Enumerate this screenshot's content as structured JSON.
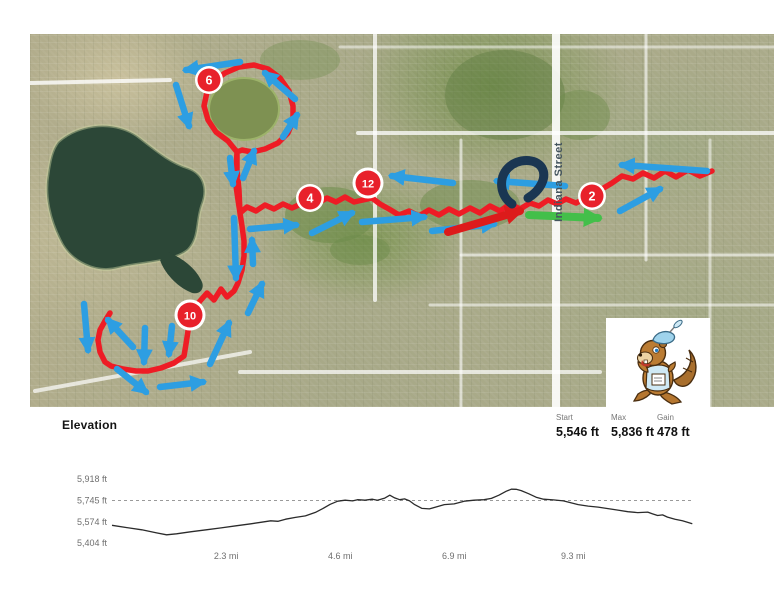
{
  "map": {
    "street_label": "Indiana Street",
    "route_color": "#ee1c25",
    "arrow_color": "#2d9ee2",
    "red_arrow_color": "#dd1b1b",
    "green_arrow_color": "#43bf4a",
    "logo_color": "#1a3652",
    "marker_fill": "#e8212b",
    "mile_markers": [
      {
        "label": "2",
        "x": 592,
        "y": 196
      },
      {
        "label": "4",
        "x": 310,
        "y": 198
      },
      {
        "label": "6",
        "x": 209,
        "y": 80
      },
      {
        "label": "10",
        "x": 190,
        "y": 315
      },
      {
        "label": "12",
        "x": 368,
        "y": 183
      }
    ],
    "route_points": [
      [
        712,
        171
      ],
      [
        700,
        176
      ],
      [
        688,
        170
      ],
      [
        676,
        177
      ],
      [
        665,
        171
      ],
      [
        654,
        178
      ],
      [
        643,
        173
      ],
      [
        633,
        179
      ],
      [
        622,
        176
      ],
      [
        612,
        183
      ],
      [
        602,
        189
      ],
      [
        594,
        194
      ],
      [
        586,
        198
      ],
      [
        576,
        203
      ],
      [
        566,
        199
      ],
      [
        557,
        204
      ],
      [
        548,
        200
      ],
      [
        539,
        206
      ],
      [
        530,
        203
      ],
      [
        520,
        209
      ],
      [
        510,
        204
      ],
      [
        500,
        211
      ],
      [
        490,
        206
      ],
      [
        480,
        213
      ],
      [
        470,
        208
      ],
      [
        459,
        214
      ],
      [
        449,
        209
      ],
      [
        439,
        215
      ],
      [
        429,
        210
      ],
      [
        419,
        216
      ],
      [
        409,
        211
      ],
      [
        399,
        215
      ],
      [
        389,
        209
      ],
      [
        380,
        204
      ],
      [
        372,
        198
      ],
      [
        363,
        200
      ],
      [
        354,
        202
      ],
      [
        345,
        197
      ],
      [
        336,
        202
      ],
      [
        327,
        198
      ],
      [
        318,
        203
      ],
      [
        310,
        199
      ],
      [
        301,
        204
      ],
      [
        292,
        208
      ],
      [
        283,
        204
      ],
      [
        274,
        209
      ],
      [
        265,
        205
      ],
      [
        256,
        211
      ],
      [
        247,
        207
      ],
      [
        240,
        213
      ],
      [
        238,
        200
      ],
      [
        236,
        186
      ],
      [
        236,
        170
      ],
      [
        237,
        152
      ],
      [
        228,
        141
      ],
      [
        216,
        132
      ],
      [
        208,
        120
      ],
      [
        204,
        106
      ],
      [
        207,
        92
      ],
      [
        214,
        81
      ],
      [
        225,
        73
      ],
      [
        239,
        67
      ],
      [
        254,
        65
      ],
      [
        268,
        69
      ],
      [
        280,
        78
      ],
      [
        289,
        91
      ],
      [
        293,
        106
      ],
      [
        293,
        121
      ],
      [
        288,
        133
      ],
      [
        278,
        143
      ],
      [
        265,
        149
      ],
      [
        252,
        152
      ],
      [
        242,
        150
      ],
      [
        237,
        152
      ],
      [
        237,
        170
      ],
      [
        239,
        190
      ],
      [
        240,
        213
      ],
      [
        242,
        226
      ],
      [
        244,
        241
      ],
      [
        244,
        256
      ],
      [
        242,
        270
      ],
      [
        238,
        283
      ],
      [
        234,
        291
      ],
      [
        227,
        297
      ],
      [
        221,
        289
      ],
      [
        214,
        300
      ],
      [
        207,
        293
      ],
      [
        200,
        301
      ],
      [
        194,
        309
      ],
      [
        190,
        318
      ],
      [
        188,
        331
      ],
      [
        186,
        344
      ],
      [
        184,
        356
      ],
      [
        174,
        363
      ],
      [
        161,
        368
      ],
      [
        148,
        371
      ],
      [
        136,
        371
      ],
      [
        123,
        369
      ],
      [
        111,
        366
      ],
      [
        105,
        362
      ],
      [
        100,
        352
      ],
      [
        98,
        340
      ],
      [
        100,
        330
      ],
      [
        105,
        321
      ],
      [
        110,
        313
      ]
    ],
    "direction_arrows": [
      [
        240,
        62,
        186,
        70
      ],
      [
        176,
        85,
        189,
        126
      ],
      [
        295,
        99,
        265,
        73
      ],
      [
        283,
        137,
        297,
        115
      ],
      [
        243,
        178,
        254,
        151
      ],
      [
        230,
        158,
        233,
        184
      ],
      [
        453,
        183,
        392,
        176
      ],
      [
        565,
        186,
        497,
        181
      ],
      [
        250,
        229,
        296,
        225
      ],
      [
        312,
        233,
        352,
        213
      ],
      [
        362,
        222,
        424,
        217
      ],
      [
        432,
        231,
        494,
        224
      ],
      [
        620,
        211,
        660,
        189
      ],
      [
        707,
        171,
        622,
        165
      ],
      [
        84,
        304,
        88,
        350
      ],
      [
        133,
        347,
        108,
        320
      ],
      [
        145,
        328,
        144,
        362
      ],
      [
        172,
        326,
        169,
        354
      ],
      [
        117,
        369,
        146,
        392
      ],
      [
        160,
        387,
        203,
        382
      ],
      [
        210,
        364,
        229,
        323
      ],
      [
        248,
        313,
        262,
        284
      ],
      [
        234,
        218,
        236,
        278
      ],
      [
        253,
        264,
        252,
        240
      ]
    ],
    "red_arrow": [
      448,
      232,
      520,
      211
    ],
    "green_arrow": [
      529,
      215,
      598,
      218
    ]
  },
  "elevation": {
    "section_label": "Elevation",
    "stats": [
      {
        "label": "Start",
        "value": "5,546 ft"
      },
      {
        "label": "Max",
        "value": "5,836 ft"
      },
      {
        "label": "Gain",
        "value": "478 ft"
      }
    ]
  },
  "chart_data": {
    "type": "line",
    "title": "Elevation",
    "x_units": "mi",
    "y_units": "ft",
    "x": [
      0,
      0.3,
      0.6,
      0.9,
      1.1,
      1.3,
      1.6,
      1.9,
      2.2,
      2.5,
      2.8,
      3.0,
      3.2,
      3.35,
      3.5,
      3.7,
      3.9,
      4.1,
      4.25,
      4.4,
      4.55,
      4.7,
      4.85,
      4.95,
      5.1,
      5.25,
      5.35,
      5.5,
      5.6,
      5.7,
      5.8,
      5.9,
      6.0,
      6.1,
      6.25,
      6.4,
      6.55,
      6.7,
      6.9,
      7.1,
      7.3,
      7.5,
      7.65,
      7.8,
      7.95,
      8.05,
      8.15,
      8.25,
      8.4,
      8.55,
      8.7,
      8.9,
      9.1,
      9.25,
      9.4,
      9.6,
      9.8,
      10.0,
      10.2,
      10.4,
      10.6,
      10.8,
      10.9,
      11.0,
      11.1,
      11.2,
      11.35,
      11.5,
      11.6,
      11.7
    ],
    "y": [
      5546,
      5528,
      5510,
      5485,
      5470,
      5478,
      5495,
      5510,
      5525,
      5542,
      5558,
      5570,
      5582,
      5578,
      5595,
      5610,
      5622,
      5650,
      5680,
      5715,
      5740,
      5748,
      5742,
      5752,
      5748,
      5756,
      5748,
      5765,
      5788,
      5766,
      5752,
      5758,
      5742,
      5712,
      5682,
      5678,
      5695,
      5712,
      5718,
      5740,
      5748,
      5752,
      5762,
      5788,
      5820,
      5836,
      5835,
      5825,
      5800,
      5772,
      5756,
      5750,
      5742,
      5728,
      5712,
      5700,
      5692,
      5680,
      5668,
      5655,
      5648,
      5652,
      5638,
      5625,
      5630,
      5612,
      5595,
      5582,
      5570,
      5558
    ],
    "x_tick_miles": [
      2.3,
      4.6,
      6.9,
      9.3
    ],
    "x_tick_labels": [
      "2.3 mi",
      "4.6 mi",
      "6.9 mi",
      "9.3 mi"
    ],
    "y_tick_ft": [
      5918,
      5745,
      5574,
      5404
    ],
    "y_tick_labels": [
      "5,918 ft",
      "5,745 ft",
      "5,574 ft",
      "5,404 ft"
    ],
    "reference_line_ft": 5745,
    "xlim": [
      0,
      11.7
    ],
    "ylim": [
      5404,
      5918
    ],
    "grid": "horizontal dashed reference line at 5,745 ft only",
    "legend": "none",
    "line_color": "#2b2b2b"
  }
}
